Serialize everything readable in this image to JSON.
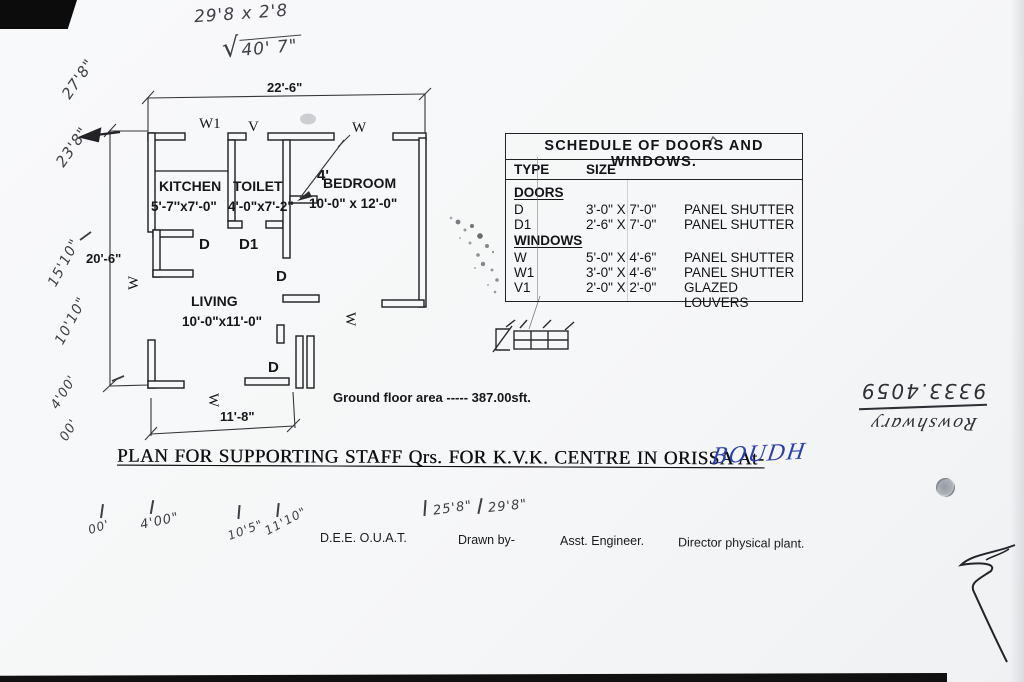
{
  "colors": {
    "paper": "#f6f7f8",
    "line": "#1d1d20",
    "pencil": "#3e3e45",
    "ink_blue": "#2b3fae"
  },
  "top_notes": {
    "calc": "29'8 x 2'8",
    "sqrt_sign": "√",
    "sqrt_value": "40' 7\""
  },
  "left_notes": [
    "27'8\"",
    "23'8\"",
    "15'10\"",
    "10'10\"",
    "4'00'",
    "00'"
  ],
  "plan": {
    "dim_top": "22'-6\"",
    "dim_left": "20'-6\"",
    "dim_bottom": "11'-8\"",
    "dim_bedroom": "4'",
    "rooms": [
      {
        "name": "KITCHEN",
        "size": "5'-7''x7'-0\""
      },
      {
        "name": "TOILET",
        "size": "4'-0\"x7'-2\""
      },
      {
        "name": "BEDROOM",
        "size": "10'-0\" x 12'-0\""
      },
      {
        "name": "LIVING",
        "size": "10'-0\"x11'-0\""
      }
    ],
    "labels": {
      "w1": "W1",
      "v": "V",
      "w": "W",
      "d": "D",
      "d1": "D1"
    },
    "area_note": "Ground floor area ----- 387.00sft."
  },
  "schedule": {
    "title": "SCHEDULE OF DOORS AND WINDOWS.",
    "col_type": "TYPE",
    "col_size": "SIZE",
    "sections": [
      {
        "heading": "DOORS",
        "rows": [
          {
            "type": "D",
            "size": "3'-0\" X 7'-0\"",
            "desc": "PANEL SHUTTER"
          },
          {
            "type": "D1",
            "size": "2'-6\" X 7'-0\"",
            "desc": "PANEL SHUTTER"
          }
        ]
      },
      {
        "heading": "WINDOWS",
        "rows": [
          {
            "type": "W",
            "size": "5'-0\" X 4'-6\"",
            "desc": "PANEL SHUTTER"
          },
          {
            "type": "W1",
            "size": "3'-0\" X 4'-6\"",
            "desc": "PANEL SHUTTER"
          },
          {
            "type": "V1",
            "size": "2'-0\" X 2'-0\"",
            "desc": "GLAZED LOUVERS"
          }
        ]
      }
    ]
  },
  "title_block": {
    "main_title": "PLAN FOR SUPPORTING STAFF Qrs. FOR K.V.K. CENTRE IN ORISSA At-",
    "location": "BOUDH",
    "office": "D.E.E. O.U.A.T.",
    "drawn_by": "Drawn by-",
    "engineer": "Asst. Engineer.",
    "director": "Director physical plant."
  },
  "bottom_marks": [
    "00'",
    "4'00\"",
    "10'5\"",
    "11'10\"",
    "25'8\"",
    "29'8\""
  ],
  "upside_down_note": {
    "line1": "9333.4059",
    "line2": "Rowshwary"
  }
}
